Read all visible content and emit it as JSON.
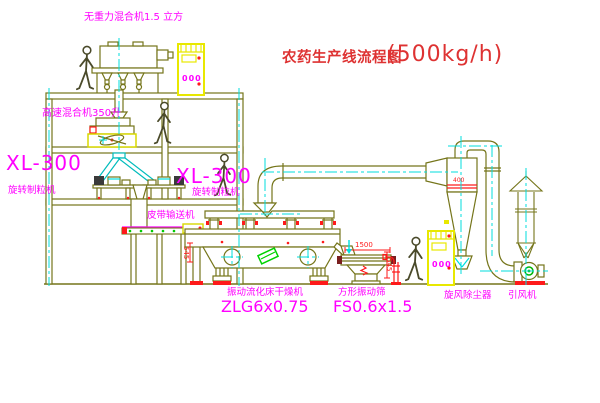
{
  "title": {
    "zh": "农药生产线流程图",
    "capacity": "(500kg/h)"
  },
  "labels": {
    "gravity_mixer": "无重力混合机1.5 立方",
    "high_speed_mixer": "高速混合机350升",
    "xl_left_model": "XL-300",
    "xl_left_name": "旋转制粒机",
    "xl_mid_model": "XL-300",
    "xl_mid_name": "旋转制粒机",
    "belt_conveyor": "皮带输送机",
    "dryer_name": "振动流化床干燥机",
    "dryer_model": "ZLG6x0.75",
    "sieve_name": "方形振动筛",
    "sieve_model": "FS0.6x1.5",
    "cyclone_name": "旋风除尘器",
    "fan_name": "引风机"
  },
  "dimensions": {
    "sieve_length": "1500",
    "sieve_height": "545",
    "dryer_feed_height": "545",
    "cyclone_mark": "400"
  },
  "cabinet": {
    "display": "000"
  },
  "colors": {
    "line_olive": "#75751a",
    "highlight_yellow": "#e8e800",
    "label_magenta": "#ff00ff",
    "annotation_red": "#fe1a1a",
    "centerline_cyan": "#00dede",
    "machine_green": "#00d200",
    "title_red": "#de3232"
  }
}
